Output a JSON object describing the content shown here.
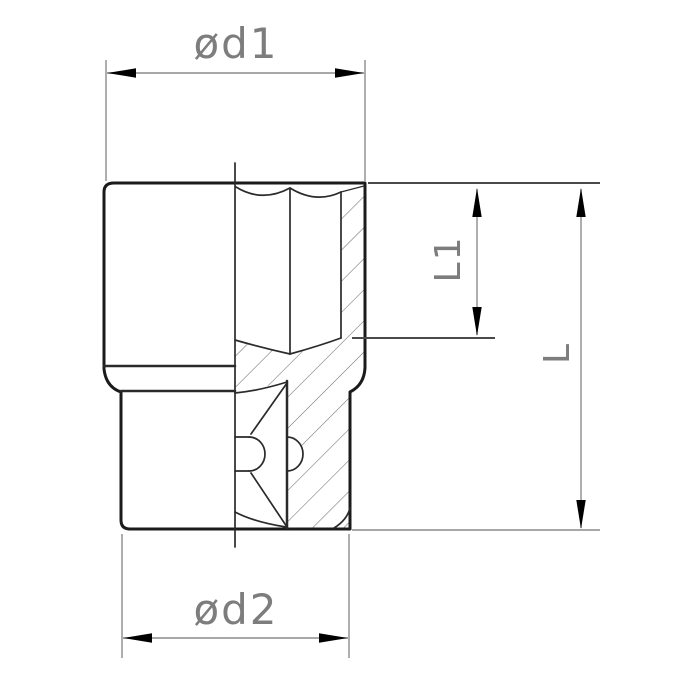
{
  "drawing": {
    "type": "technical-drawing",
    "subject": "socket wrench socket cross-section",
    "labels": {
      "d1": "ød1",
      "d2": "ød2",
      "l1": "L1",
      "l": "L"
    }
  },
  "colors": {
    "background": "#ffffff",
    "outline": "#1b1b1b",
    "detail": "#2a2a2a",
    "dimension": "#8c8c8c",
    "extension_dark": "#4a4a4a",
    "hatch": "#6f6f6f",
    "arrow": "#000000",
    "label_text": "#7d7d7d"
  }
}
